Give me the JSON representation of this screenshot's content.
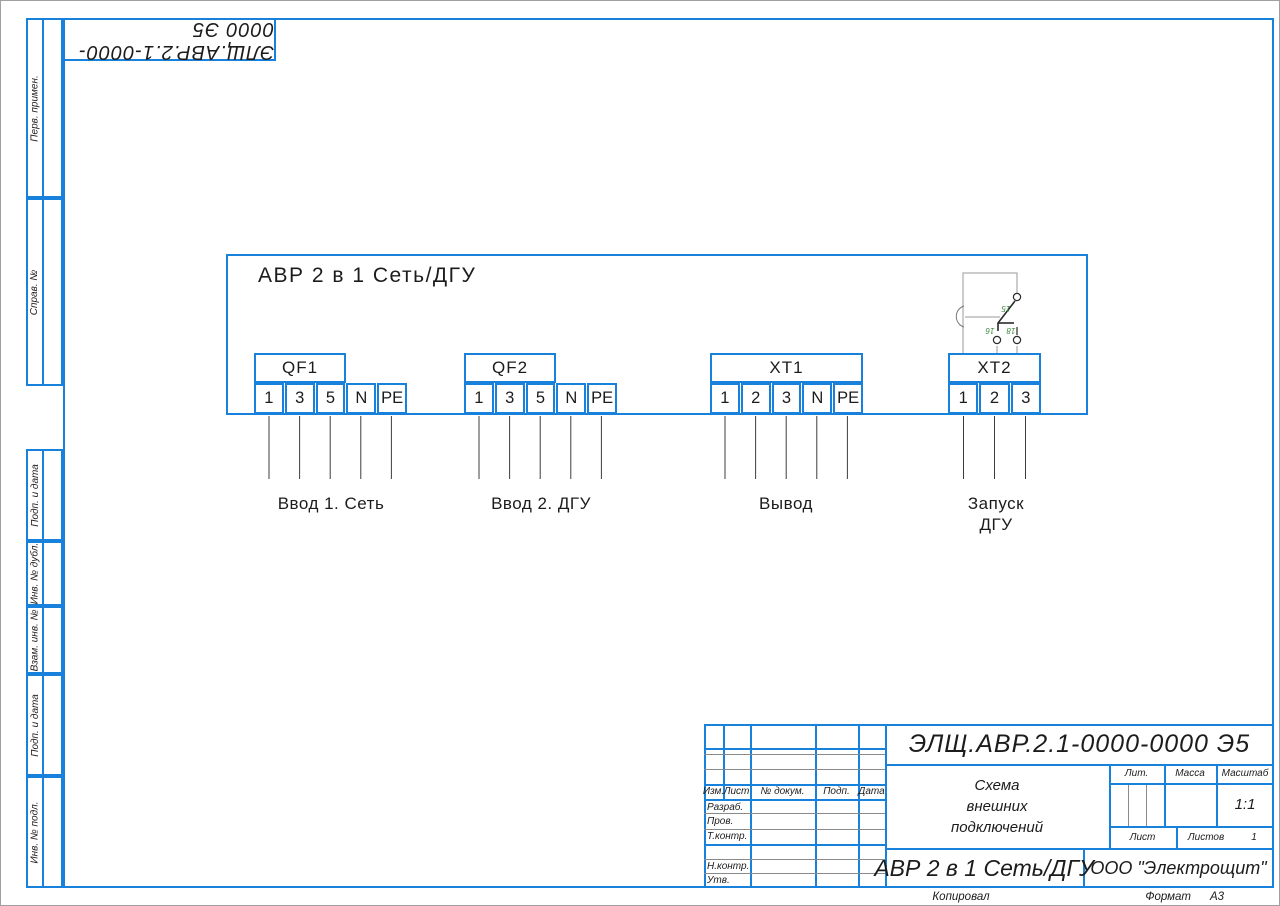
{
  "frame": {
    "stamp_rotated": "ЭЛЩ.АВР.2.1-0000-0000 Э5",
    "margin_labels": [
      "Перв. примен.",
      "Справ. №",
      "Подп. и дата",
      "Инв. № дубл.",
      "Взам. инв. №",
      "Подп. и дата",
      "Инв. № подл."
    ],
    "copied": "Копировал",
    "format_label": "Формат",
    "format_value": "А3"
  },
  "schematic": {
    "title": "АВР 2 в 1 Сеть/ДГУ",
    "blocks": [
      {
        "name": "QF1",
        "terminals": [
          "1",
          "3",
          "5",
          "N",
          "PE"
        ],
        "caption": "Ввод 1. Сеть"
      },
      {
        "name": "QF2",
        "terminals": [
          "1",
          "3",
          "5",
          "N",
          "PE"
        ],
        "caption": "Ввод 2. ДГУ"
      },
      {
        "name": "XT1",
        "terminals": [
          "1",
          "2",
          "3",
          "N",
          "PE"
        ],
        "caption": "Вывод"
      },
      {
        "name": "XT2",
        "terminals": [
          "1",
          "2",
          "3"
        ],
        "caption": "Запуск\nДГУ"
      }
    ],
    "relay_contact": {
      "common": "15",
      "nc": "16",
      "no": "18"
    }
  },
  "title_block": {
    "doc_number": "ЭЛЩ.АВР.2.1-0000-0000 Э5",
    "doc_name": "Схема\nвнешних\nподключений",
    "product": "АВР 2 в 1 Сеть/ДГУ",
    "company": "ООО \"Электрощит\"",
    "header_cols": [
      "Изм.",
      "Лист",
      "№ докум.",
      "Подп.",
      "Дата"
    ],
    "roles": [
      "Разраб.",
      "Пров.",
      "Т.контр.",
      "Н.контр.",
      "Утв."
    ],
    "lit_label": "Лит.",
    "mass_label": "Масса",
    "scale_label": "Масштаб",
    "scale_value": "1:1",
    "sheet_label": "Лист",
    "sheets_label": "Листов",
    "sheets_value": "1"
  }
}
